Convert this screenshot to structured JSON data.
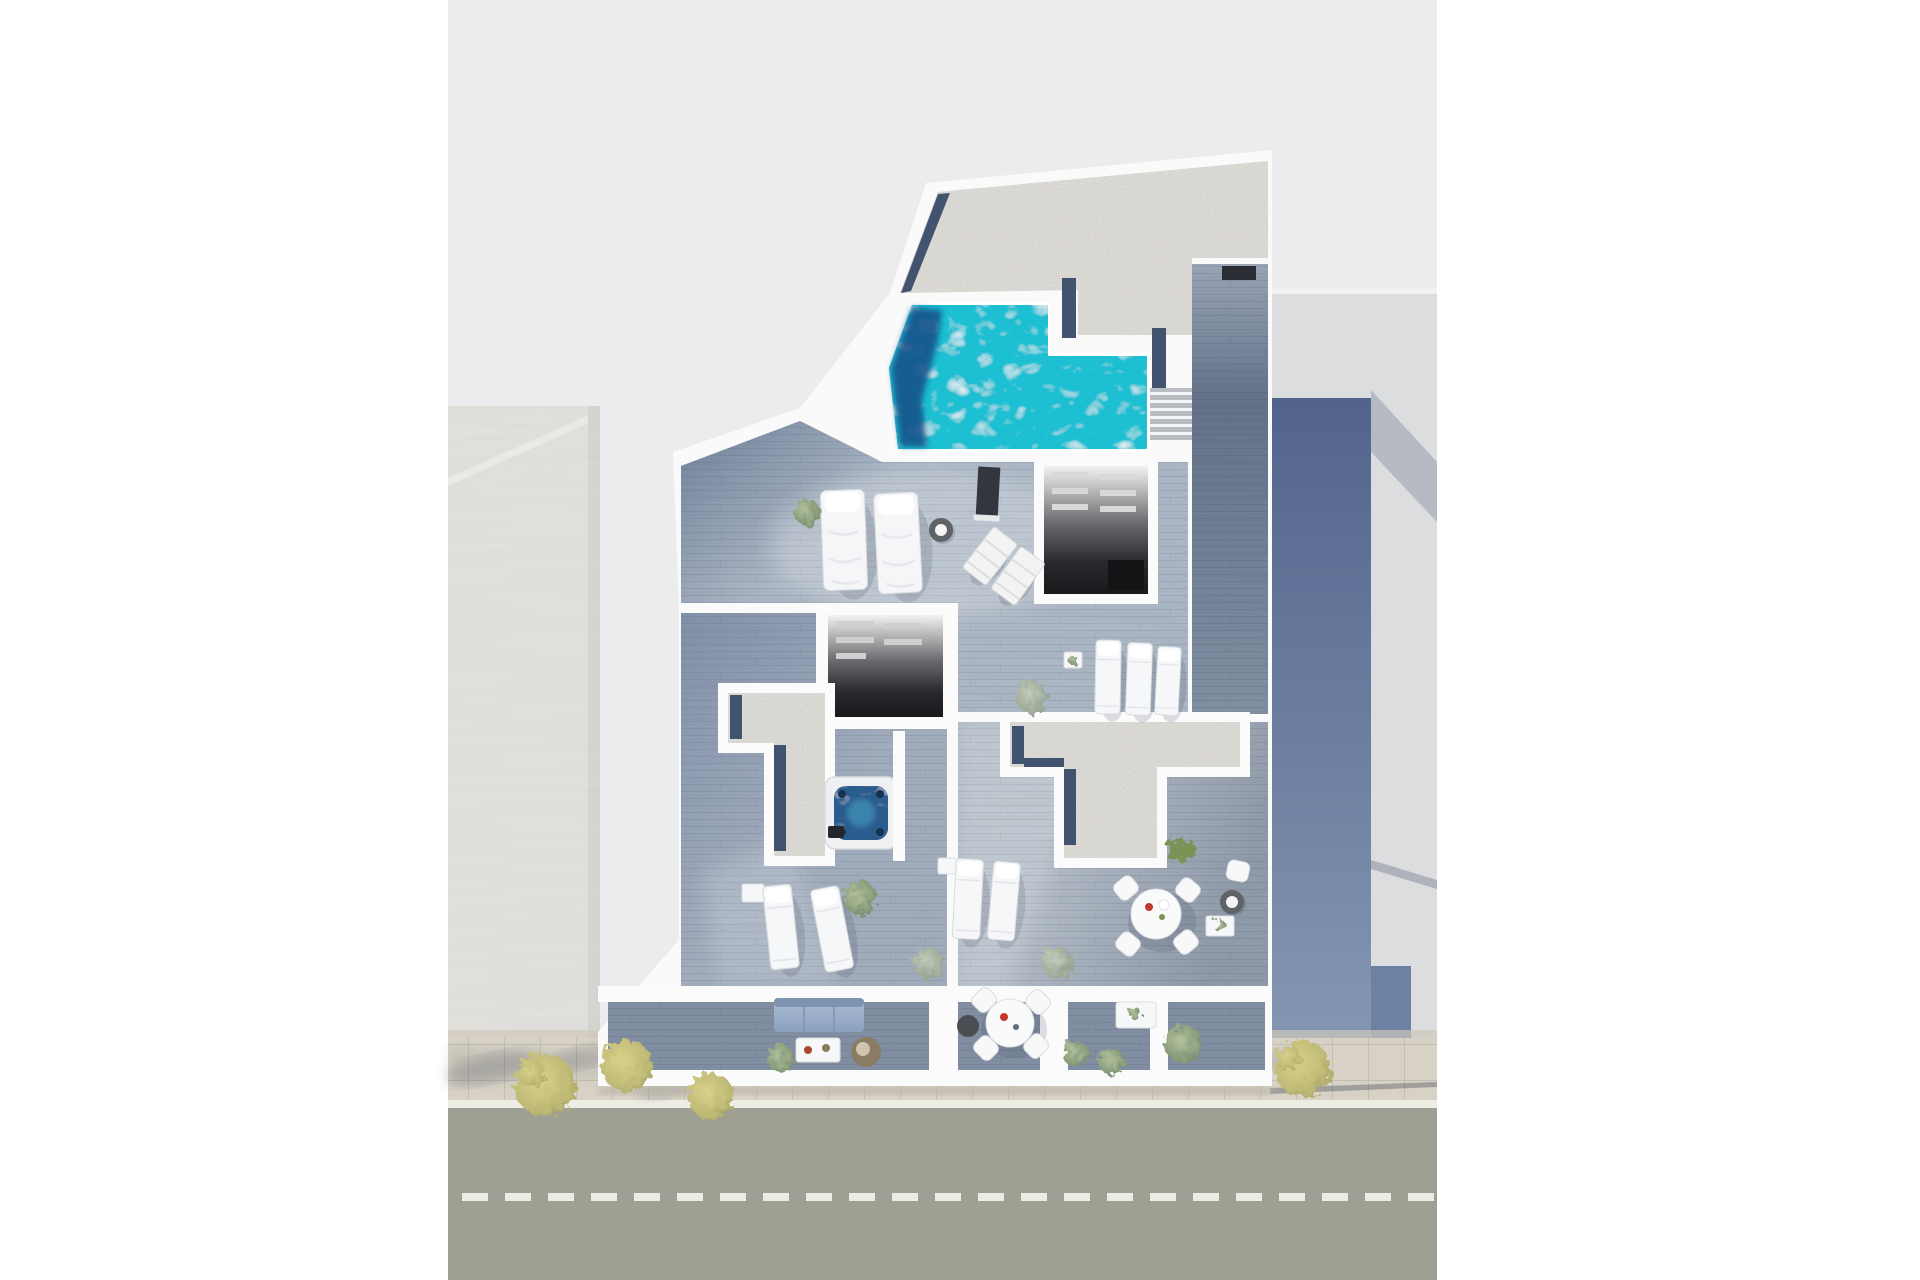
{
  "scene": {
    "kind": "aerial-3d-floor-plan-render",
    "subject": "apartment-building-cutaway-with-roof-pool",
    "view": "top-down-axonometric",
    "visible_text": "none"
  },
  "colors": {
    "page_margin": "#ffffff",
    "canvas_bg": "#ececee",
    "building_walls": "#fafafb",
    "roof_gravel": "#e6e4df",
    "gravel_border": "#41536f",
    "pool_water": "#1fc0d2",
    "pool_shadow": "#14518a",
    "hot_tub_water": "#2a5c8e",
    "wood_upper": "#aeb9c6",
    "wood_corridor": "#9aa6b6",
    "wood_left_wing": "#a7b2c0",
    "wood_right_wing": "#b6bfc9",
    "wood_balcony": "#94a2b4",
    "dark_room_floor": "#1c1c1f",
    "neighbor_left_roof": "#e3e2dd",
    "neighbor_right_roof": "#dcddde",
    "shadow_band_top": "#52648c",
    "shadow_band_bottom": "#8496b2",
    "shadow_wedge": "#b6bac3",
    "street_asphalt": "#9da092",
    "road_marking": "#f4f3ec",
    "sidewalk_paving": "#d7d2c5",
    "tree_olive": "#c6c07c",
    "plant_green": "#8ba077",
    "hedge_green": "#7a9455",
    "sofa_fabric": "#9db2cb"
  },
  "street": {
    "edge_line_style": "solid-white",
    "center_line_style": "dashed-white",
    "dash_length_px": 26,
    "dash_gap_px": 17
  },
  "inventory": {
    "pools": 1,
    "hot_tubs": 1,
    "stair_flights": 1,
    "dark_room_cutaways": 2,
    "gravel_terraces": 3,
    "daybeds": 2,
    "sun_loungers": 7,
    "folding_deck_chairs": 2,
    "round_dining_sets": 2,
    "sofas": 1,
    "coffee_tables": 1,
    "poufs": 2,
    "side_tables": 6,
    "potted_plants": 9,
    "street_trees": 4,
    "hedges": 1
  }
}
